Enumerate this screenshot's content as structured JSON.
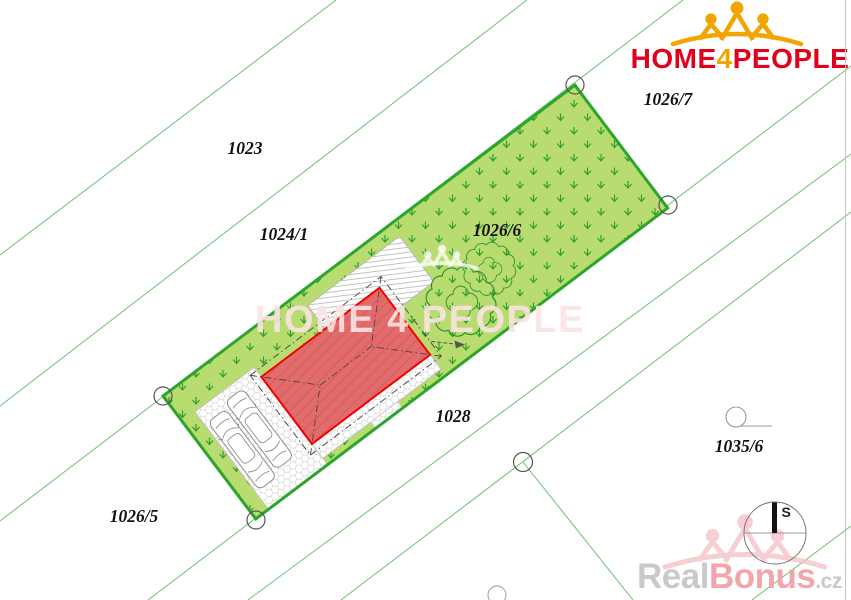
{
  "logo": {
    "word1": "HOME",
    "word2": "4",
    "word3": "PEOPLE"
  },
  "center_watermark": {
    "text": "HOME 4 PEOPLE"
  },
  "footer_watermark": {
    "part1": "Real",
    "part2": "Bonus",
    "part3": ".cz"
  },
  "compass": {
    "north_label": "S"
  },
  "parcels": [
    {
      "label": "1023"
    },
    {
      "label": "1024/1"
    },
    {
      "label": "1026/6"
    },
    {
      "label": "1026/7"
    },
    {
      "label": "1028"
    },
    {
      "label": "1026/5"
    },
    {
      "label": "1035/6"
    }
  ],
  "colors": {
    "brand_red": "#e2001a",
    "brand_gold": "#f0a500",
    "plot_fill": "#b9dc70",
    "plot_border": "#2ba52b",
    "grass_symbol": "#2f9e2f",
    "boundary_line": "#6fbf6f",
    "house_fill": "#e26b6b",
    "house_border": "#f40000",
    "watermark_pink": "#fbe3e3",
    "footer_grey": "#c9c9c9",
    "footer_pink": "#f2a6ac",
    "logo_ghost_pink": "#f6c3c7"
  }
}
